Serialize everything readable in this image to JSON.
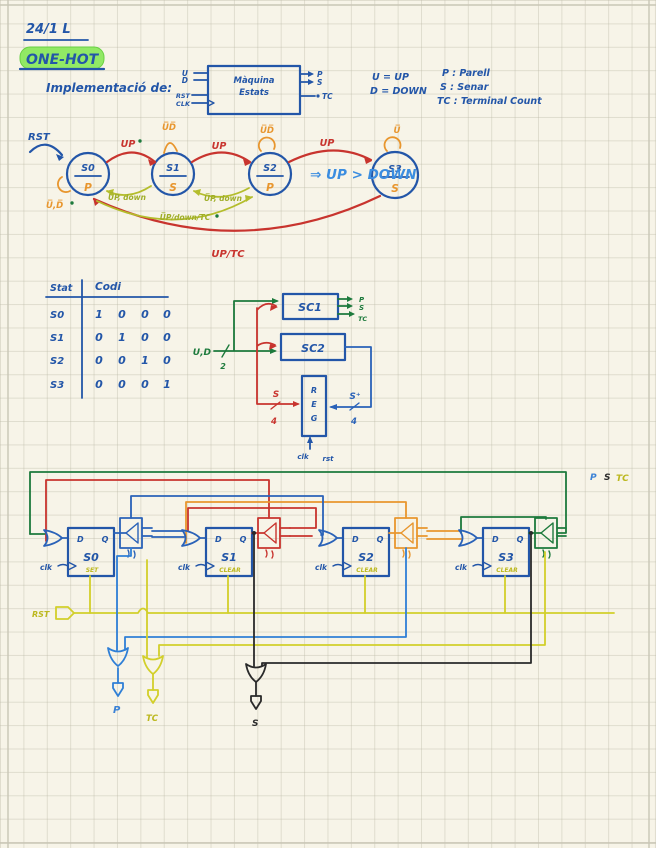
{
  "page": {
    "date": "24/1 L",
    "title": "ONE-HOT",
    "subtitle": "Implementació de:"
  },
  "machine": {
    "name_line1": "Màquina",
    "name_line2": "Estats",
    "inputs": [
      "U",
      "D",
      "RST",
      "CLK"
    ],
    "outputs": [
      "P",
      "S",
      "TC"
    ]
  },
  "legend": {
    "u": "U = UP",
    "d": "D = DOWN",
    "p": "P : Parell",
    "s": "S : Senar",
    "tc": "TC : Terminal Count"
  },
  "state_diagram": {
    "reset": "RST",
    "states": [
      {
        "name": "S0",
        "out": "P"
      },
      {
        "name": "S1",
        "out": "S"
      },
      {
        "name": "S2",
        "out": "P"
      },
      {
        "name": "S3",
        "out": "S"
      }
    ],
    "up": "UP",
    "loop_s0": "U̅,D̅",
    "loop_s1": "U̅D̅",
    "loop_s2": "U̅D̅",
    "loop_s3": "U̅",
    "down1": "U̅P, down",
    "down2": "U̅P, down",
    "down3": "U̅P/down/TC",
    "wrap": "UP/TC",
    "conclusion": "⇒  UP > DOWN"
  },
  "table": {
    "col1": "Stat",
    "col2": "Codi",
    "rows": [
      {
        "state": "S0",
        "b0": "1",
        "b1": "0",
        "b2": "0",
        "b3": "0"
      },
      {
        "state": "S1",
        "b0": "0",
        "b1": "1",
        "b2": "0",
        "b3": "0"
      },
      {
        "state": "S2",
        "b0": "0",
        "b1": "0",
        "b2": "1",
        "b3": "0"
      },
      {
        "state": "S3",
        "b0": "0",
        "b1": "0",
        "b2": "0",
        "b3": "1"
      }
    ]
  },
  "blocks": {
    "ud": "U,D",
    "ud_w": "2",
    "sc1": "SC1",
    "sc2": "SC2",
    "reg": [
      "R",
      "E",
      "G"
    ],
    "s": "S",
    "s_w": "4",
    "splus": "S⁺",
    "splus_w": "4",
    "clk": "clk",
    "rst": "rst",
    "o_p": "P",
    "o_s": "S",
    "o_tc": "TC"
  },
  "circuit": {
    "ffs": [
      {
        "name": "S0",
        "mode": "SET"
      },
      {
        "name": "S1",
        "mode": "CLEAR"
      },
      {
        "name": "S2",
        "mode": "CLEAR"
      },
      {
        "name": "S3",
        "mode": "CLEAR"
      }
    ],
    "d": "D",
    "q": "Q",
    "clk": "clk",
    "rst": "RST",
    "p": "P",
    "s": "S",
    "tc": "TC"
  }
}
